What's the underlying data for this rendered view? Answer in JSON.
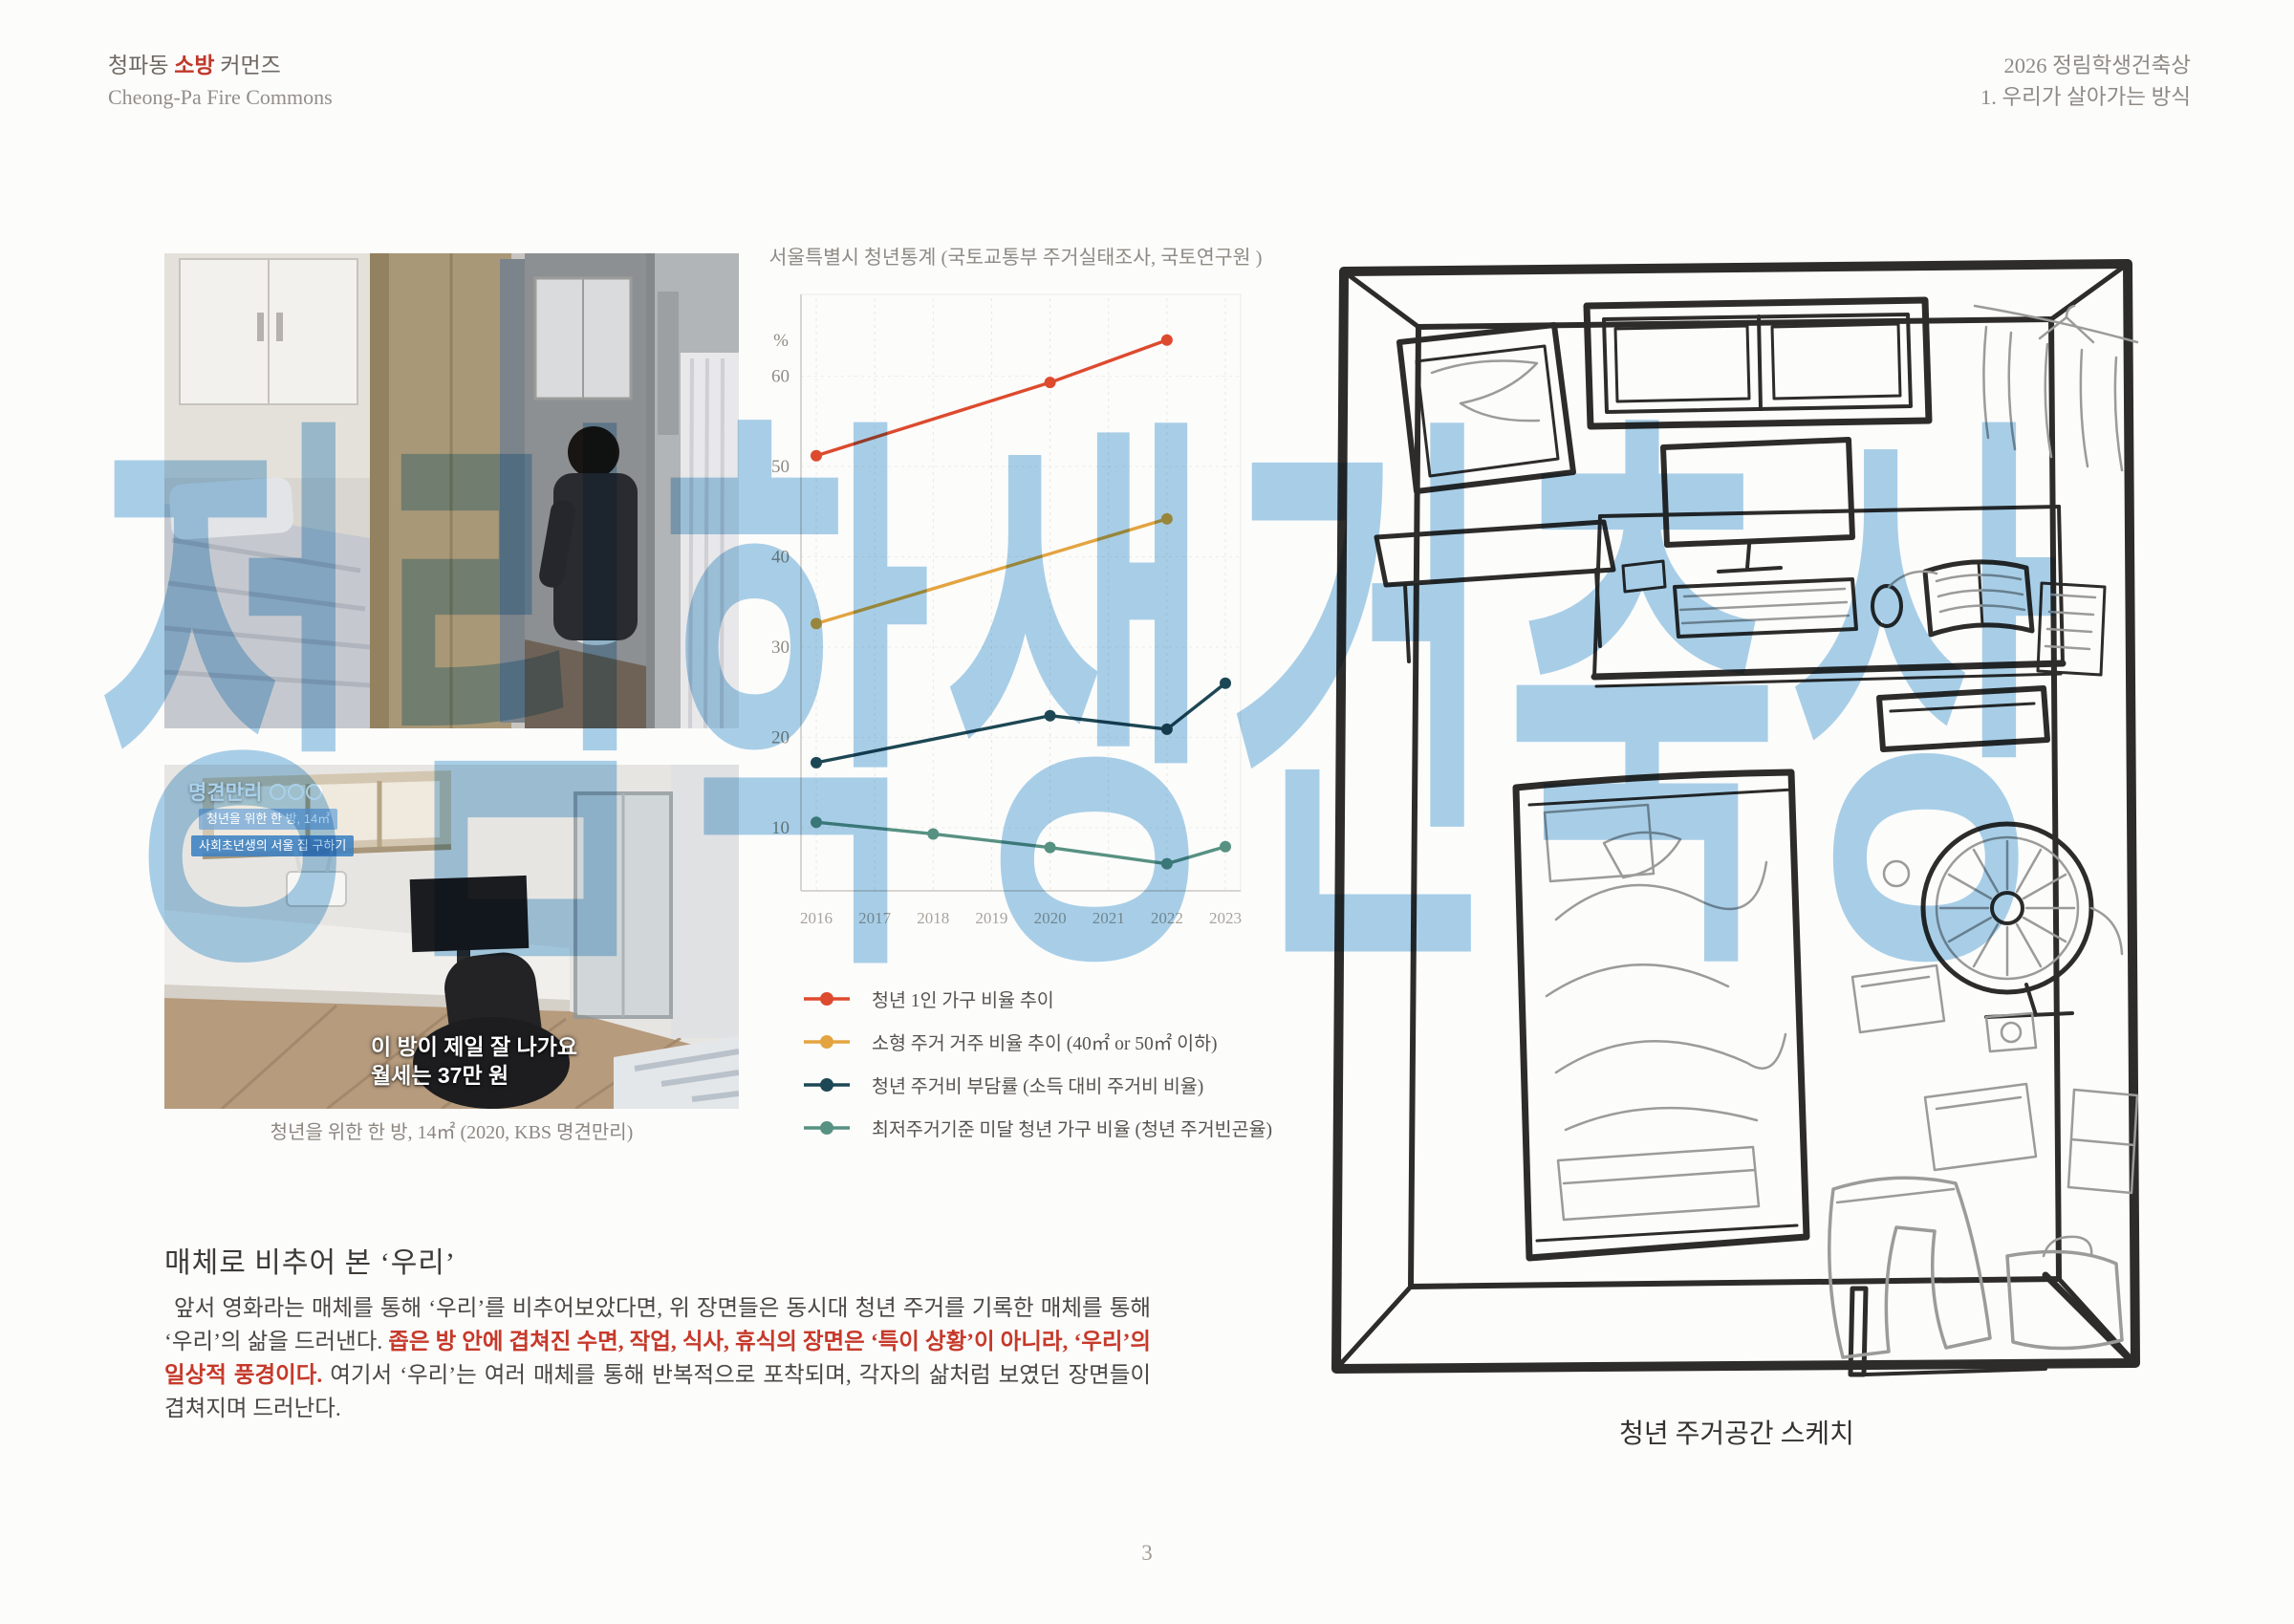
{
  "header": {
    "left_title_pre": "청파동 ",
    "left_title_accent": "소방",
    "left_title_post": " 커먼즈",
    "left_subtitle": "Cheong-Pa Fire Commons",
    "right_title": "2026 정림학생건축상",
    "right_subtitle": "1. 우리가 살아가는 방식",
    "accent_color": "#c0392b"
  },
  "watermark": {
    "text": "정림학생건축상",
    "color": "#a3cdea"
  },
  "photos": {
    "photo2_overlay": {
      "program_logo": "명견만리",
      "chip_line1": "청년을 위한 한 방, 14㎡",
      "chip_line2": "사회초년생의 서울 집 구하기",
      "subtitle_line1": "이 방이 제일 잘 나가요",
      "subtitle_line2": "월세는 37만 원"
    },
    "caption": "청년을 위한 한 방, 14㎡ (2020, KBS 명견만리)"
  },
  "chart_data": {
    "type": "line",
    "title": "서울특별시 청년통계 (국토교통부 주거실태조사, 국토연구원 )",
    "x_categories": [
      "2016",
      "2017",
      "2018",
      "2019",
      "2020",
      "2021",
      "2022",
      "2023"
    ],
    "y_unit": "%",
    "y_ticks": [
      10,
      20,
      30,
      40,
      50,
      60
    ],
    "ylim": [
      3,
      68
    ],
    "grid": true,
    "legend_position": "below",
    "series": [
      {
        "name": "청년 1인 가구 비율 추이",
        "color": "#dd4a2e",
        "x": [
          2016,
          2020,
          2022
        ],
        "values": [
          51.2,
          59.3,
          64.0
        ]
      },
      {
        "name": "소형 주거 거주 비율 추이 (40㎡ or 50㎡ 이하)",
        "color": "#e3a440",
        "x": [
          2016,
          2022
        ],
        "values": [
          32.6,
          44.2
        ]
      },
      {
        "name": "청년 주거비 부담률 (소득 대비 주거비 비율)",
        "color": "#1d4754",
        "x": [
          2016,
          2020,
          2022,
          2023
        ],
        "values": [
          17.2,
          22.4,
          20.9,
          26.0
        ]
      },
      {
        "name": "최저주거기준 미달 청년 가구 비율 (청년 주거빈곤율)",
        "color": "#579182",
        "x": [
          2016,
          2018,
          2020,
          2022,
          2023
        ],
        "values": [
          10.6,
          9.3,
          7.8,
          6.0,
          7.9
        ]
      }
    ]
  },
  "section": {
    "heading": "매체로 비추어 본 ‘우리’",
    "p_normal1": " 앞서 영화라는 매체를 통해 ‘우리’를 비추어보았다면,  위 장면들은 동시대 청년 주거를 기록한 매체를 통해 ‘우리’의 삶을 드러낸다. ",
    "p_red": "좁은 방 안에 겹쳐진 수면, 작업, 식사, 휴식의 장면은 ‘특이 상황’이 아니라, ‘우리’의 일상적 풍경이다.",
    "p_normal2": " 여기서 ‘우리’는 여러 매체를 통해 반복적으로 포착되며, 각자의 삶처럼 보였던 장면들이 겹쳐지며 드러난다."
  },
  "sketch": {
    "caption": "청년 주거공간 스케치"
  },
  "page": {
    "number": "3"
  }
}
